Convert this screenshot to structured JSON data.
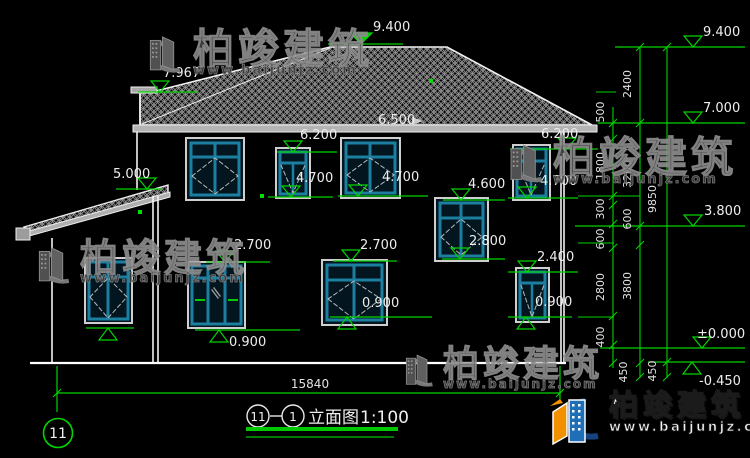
{
  "drawing": {
    "facade_marks": [
      {
        "label": "7.967"
      },
      {
        "label": "9.400"
      },
      {
        "label": "6.500"
      },
      {
        "label": "6.200"
      },
      {
        "label": "5.000"
      },
      {
        "label": "4.700"
      },
      {
        "label": "4.700"
      },
      {
        "label": "6.200"
      },
      {
        "label": "4.700"
      },
      {
        "label": "4.600"
      },
      {
        "label": "2.800"
      },
      {
        "label": "2.700"
      },
      {
        "label": "2.700"
      },
      {
        "label": "2.400"
      },
      {
        "label": "0.900"
      },
      {
        "label": "0.900"
      },
      {
        "label": "0.900"
      }
    ],
    "right_levels": [
      "9.400",
      "7.000",
      "3.800",
      "±0.000",
      "-0.450"
    ],
    "chains": {
      "a": [
        "500",
        "1800",
        "300",
        "600",
        "2800",
        "400"
      ],
      "b": [
        "2400",
        "3200",
        "600",
        "3800",
        "450"
      ],
      "c": [
        "9850",
        "450"
      ]
    },
    "bottom_dim": "15840",
    "grid_bubble": "11"
  },
  "title_block": {
    "bubble_left": "11",
    "bubble_right": "1",
    "name": "立面图",
    "scale": "1:100"
  },
  "watermark": {
    "brand": "柏竣建筑",
    "site": "www.baijunjz.com"
  },
  "logo": {
    "brand": "柏竣建筑",
    "site": "www.baijunjz.com"
  },
  "colors": {
    "bg": "#000000",
    "line": "#ffffff",
    "dim_green": "#00d400",
    "window_teal": "#1d7fa0"
  }
}
